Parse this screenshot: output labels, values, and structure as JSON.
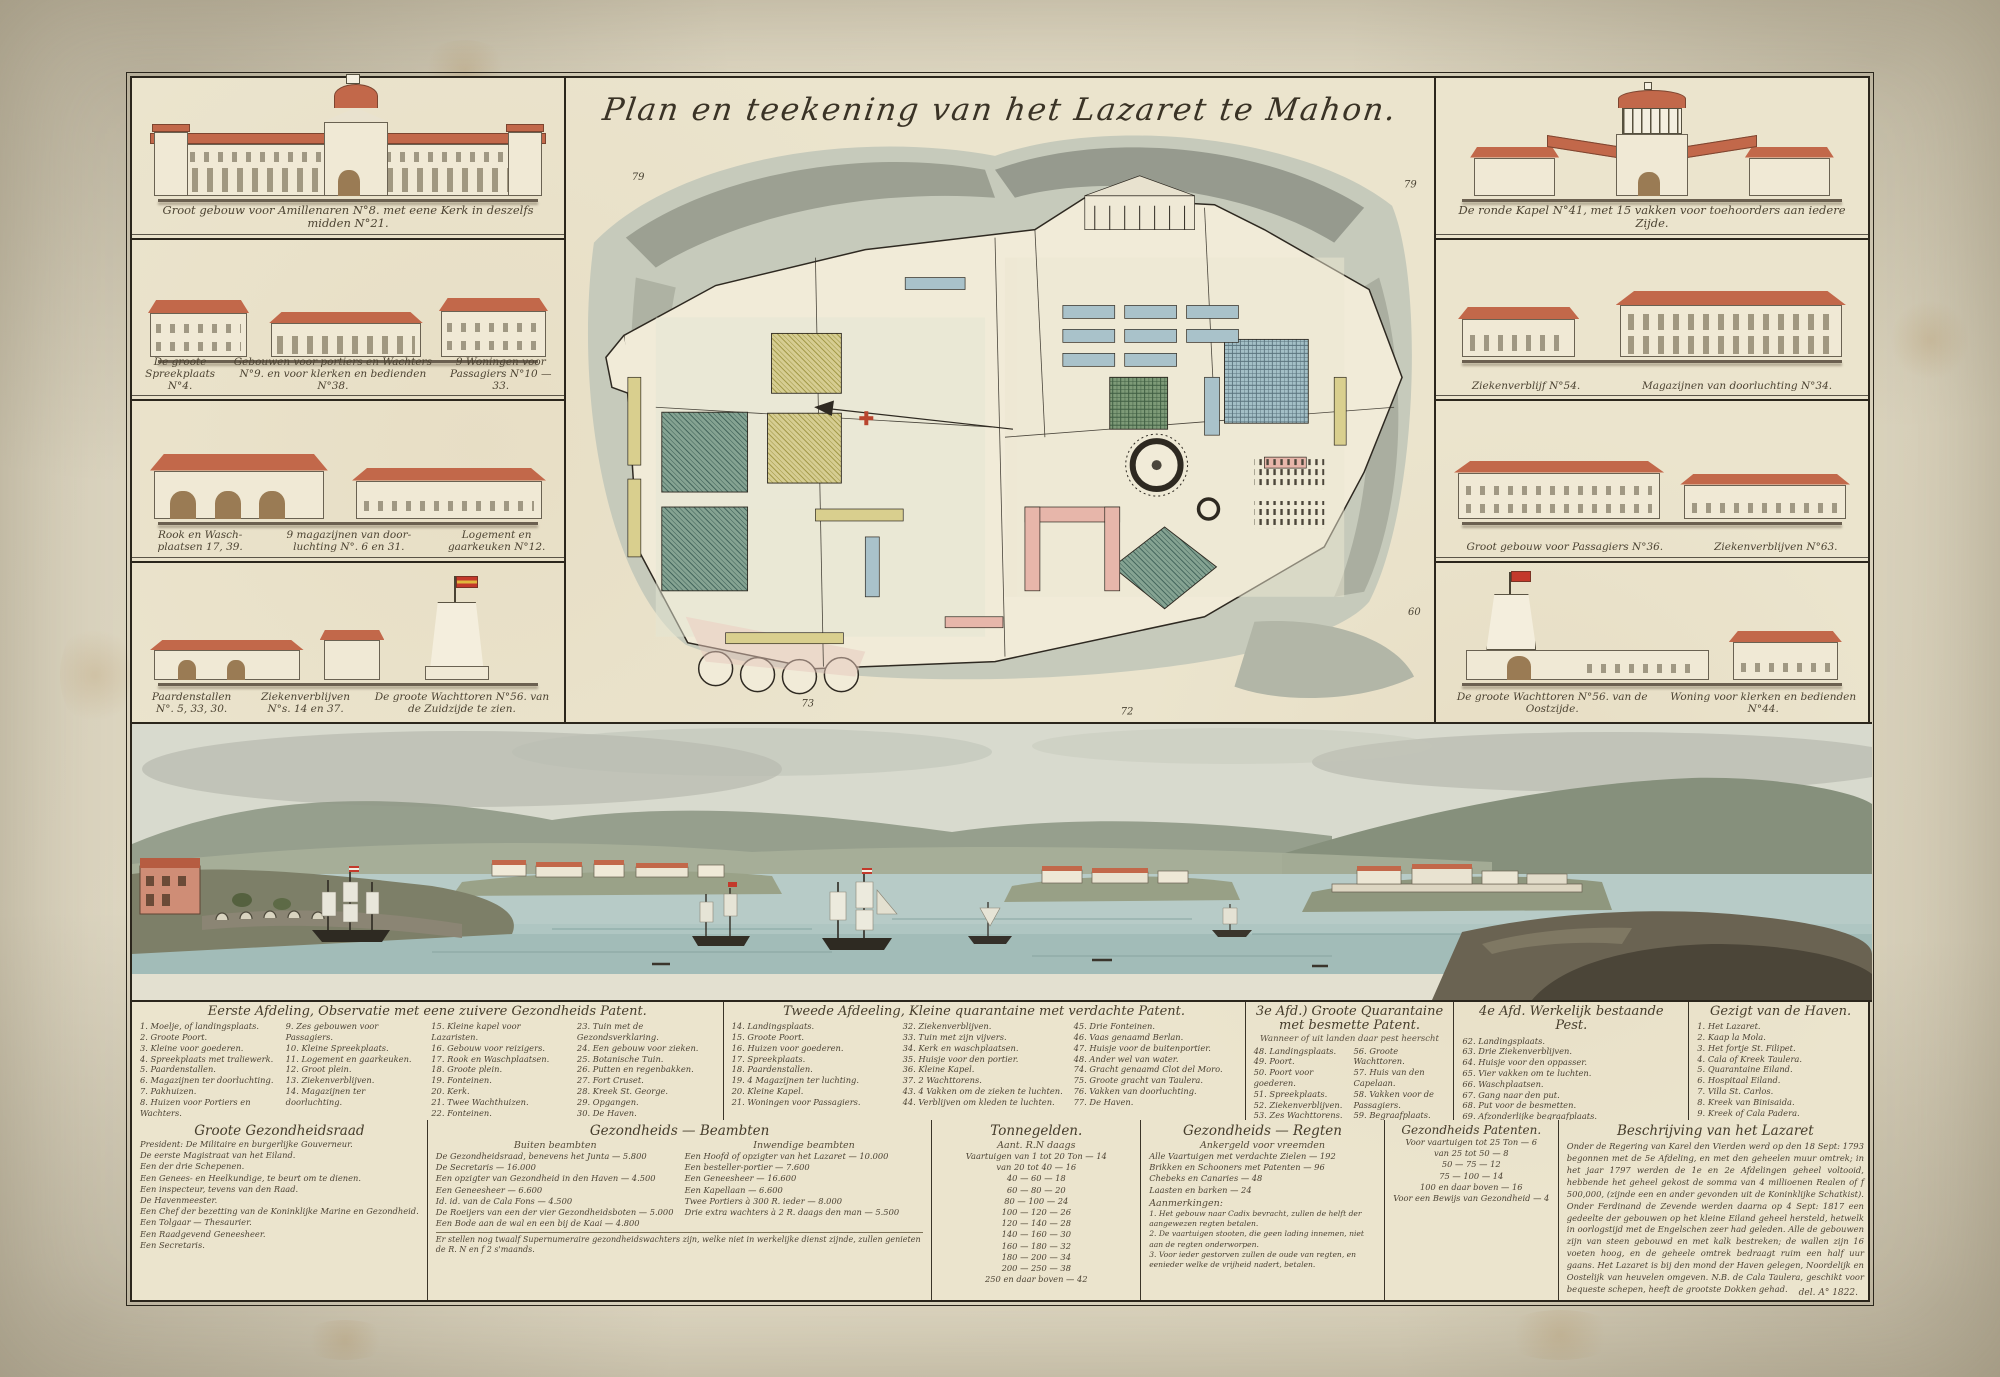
{
  "title": "Plan en teekening van het Lazaret te Mahon.",
  "left_panels": [
    {
      "caption_parts": [
        "Groot gebouw voor Amillenaren N°8. met eene Kerk in deszelfs midden N°21."
      ]
    },
    {
      "caption_parts": [
        "De groote Spreekplaats N°4.",
        "Gebouwen voor portiers en Wachters N°9. en voor klerken en bedienden N°38.",
        "9 Woningen voor Passagiers N°10 — 33."
      ]
    },
    {
      "caption_parts": [
        "Rook en Wasch- plaatsen 17, 39.",
        "9 magazijnen van door- luchting N°. 6 en 31.",
        "Logement en gaarkeuken N°12."
      ]
    },
    {
      "caption_parts": [
        "Paardenstallen N°. 5, 33, 30.",
        "Ziekenverblijven N°s. 14 en 37.",
        "De groote Wachttoren N°56. van de Zuidzijde te zien."
      ]
    }
  ],
  "right_panels": [
    {
      "caption_parts": [
        "De ronde Kapel N°41, met 15 vakken voor toehoorders aan iedere Zijde."
      ]
    },
    {
      "caption_parts": [
        "Ziekenverblijf N°54.",
        "Magazijnen van doorluchting N°34."
      ]
    },
    {
      "caption_parts": [
        "Groot gebouw voor Passagiers N°36.",
        "Ziekenverblijven N°63."
      ]
    },
    {
      "caption_parts": [
        "De groote Wachttoren N°56. van de Oostzijde.",
        "Woning voor klerken en bedienden N°44."
      ]
    }
  ],
  "plan": {
    "numbers": [
      "79",
      "79",
      "60",
      "73",
      "72"
    ]
  },
  "legend_columns": [
    {
      "header": "Eerste Afdeling, Observatie met eene zuivere Gezondheids Patent.",
      "subheader": "",
      "entries": [
        "1. Moelje, of landingsplaats.",
        "2. Groote Poort.",
        "3. Kleine voor goederen.",
        "4. Spreekplaats met traliewerk.",
        "5. Paardenstallen.",
        "6. Magazijnen ter doorluchting.",
        "7. Pakhuizen.",
        "8. Huizen voor Portiers en Wachters.",
        "9. Zes gebouwen voor Passagiers.",
        "10. Kleine Spreekplaats.",
        "11. Logement en gaarkeuken.",
        "12. Groot plein.",
        "13. Ziekenverblijven.",
        "14. Magazijnen ter doorluchting.",
        "15. Kleine kapel voor Lazaristen.",
        "16. Gebouw voor reizigers.",
        "17. Rook en Waschplaatsen.",
        "18. Groote plein.",
        "19. Fonteinen.",
        "20. Kerk.",
        "21. Twee Wachthuizen.",
        "22. Fonteinen.",
        "23. Tuin met de Gezondsverklaring.",
        "24. Een gebouw voor zieken.",
        "25. Botanische Tuin.",
        "26. Putten en regenbakken.",
        "27. Fort Cruset.",
        "28. Kreek St. George.",
        "29. Opgangen.",
        "30. De Haven."
      ]
    },
    {
      "header": "Tweede Afdeeling, Kleine quarantaine met verdachte Patent.",
      "subheader": "",
      "entries": [
        "14. Landingsplaats.",
        "15. Groote Poort.",
        "16. Huizen voor goederen.",
        "17. Spreekplaats.",
        "18. Paardenstallen.",
        "19. 4 Magazijnen ter luchting.",
        "20. Kleine Kapel.",
        "21. Woningen voor Passagiers.",
        "32. Ziekenverblijven.",
        "33. Tuin met zijn vijvers.",
        "34. Kerk en waschplaatsen.",
        "35. Huisje voor den portier.",
        "36. Kleine Kapel.",
        "37. 2 Wachttorens.",
        "43. 4 Vakken om de zieken te luchten.",
        "44. Verblijven om kleden te luchten.",
        "45. Drie Fonteinen.",
        "46. Vaas genaamd Berlan.",
        "47. Huisje voor de buitenportier.",
        "48. Ander wel van water.",
        "74. Gracht genaamd Clot del Moro.",
        "75. Groote gracht van Taulera.",
        "76. Vakken van doorluchting.",
        "77. De Haven."
      ]
    },
    {
      "header": "3e Afd.) Groote Quarantaine met besmette Patent.",
      "subheader": "Wanneer of uit landen daar pest heerscht",
      "entries": [
        "48. Landingsplaats.",
        "49. Poort.",
        "50. Poort voor goederen.",
        "51. Spreekplaats.",
        "52. Ziekenverblijven.",
        "53. Zes Wachttorens.",
        "54. Vier Kamers.",
        "55. Magazijnen ter luchting.",
        "56. Groote Wachttoren.",
        "57. Huis van den Capelaan.",
        "58. Vakken voor de Passagiers.",
        "59. Begraafplaats.",
        "60. 3 Gebouwen voor Passagiers."
      ]
    },
    {
      "header": "4e Afd. Werkelijk bestaande Pest.",
      "subheader": "",
      "entries": [
        "62. Landingsplaats.",
        "63. Drie Ziekenverblijven.",
        "64. Huisje voor den oppasser.",
        "65. Vier vakken om te luchten.",
        "66. Waschplaatsen.",
        "67. Gang naar den put.",
        "68. Put voor de besmetten.",
        "69. Afzonderlijke begraafplaats.",
        "70. Binnen ingang."
      ]
    },
    {
      "header": "Gezigt van de Haven.",
      "subheader": "",
      "entries": [
        "1. Het Lazaret.",
        "2. Kaap la Mola.",
        "3. Het fortje St. Filipet.",
        "4. Cala of Kreek Taulera.",
        "5. Quarantaine Eiland.",
        "6. Hospitaal Eiland.",
        "7. Villa St. Carlos.",
        "8. Kreek van Binisaida.",
        "9. Kreek of Cala Padera."
      ]
    }
  ],
  "bottom_sections": {
    "raad": {
      "header": "Groote Gezondheidsraad",
      "lines": [
        "President: De Militaire en burgerlijke Gouverneur.",
        "De eerste Magistraat van het Eiland.",
        "Een der drie Schepenen.",
        "Een Genees- en Heelkundige, te beurt om te dienen.",
        "Een inspecteur, tevens van den Raad.",
        "De Havenmeester.",
        "Een Chef der bezetting van de Koninklijke Marine en Gezondheid.",
        "Een Tolgaar — Thesaurier.",
        "Een Raadgevend Geneesheer.",
        "Een Secretaris."
      ]
    },
    "beambten": {
      "header": "Gezondheids — Beambten",
      "sub_left": "Buiten beambten",
      "sub_right": "Inwendige beambten",
      "amount_label": "Amb. R.N",
      "left_rows": [
        "De Gezondheidsraad, benevens het Junta — 5.800",
        "De Secretaris — 16.000",
        "Een opzigter van Gezondheid in den Haven — 4.500",
        "Een Geneesheer — 6.600",
        "Id. id. van de Cala Fons — 4.500",
        "De Roeijers van een der vier Gezondheidsboten — 5.000",
        "Een Bode aan de wal en een bij de Kaai — 4.800"
      ],
      "right_rows": [
        "Een Hoofd of opzigter van het Lazaret — 10.000",
        "Een besteller-portier — 7.600",
        "Een Geneesheer — 16.600",
        "Een Kapellaan — 6.600",
        "Twee Portiers à 300 R. ieder — 8.000",
        "Drie extra wachters à 2 R. daags den man — 5.500"
      ],
      "footer": "Er stellen nog twaalf Supernumeraire gezondheidswachters zijn, welke niet in werkelijke dienst zijnde, zullen genieten de R. N en f 2 s'maands."
    },
    "tonnegelden": {
      "header": "Tonnegelden.",
      "amount_label": "Aant. R.N daags",
      "rows": [
        "Vaartuigen van 1 tot 20 Ton — 14",
        "van 20 tot 40 — 16",
        "40 — 60 — 18",
        "60 — 80 — 20",
        "80 — 100 — 24",
        "100 — 120 — 26",
        "120 — 140 — 28",
        "140 — 160 — 30",
        "160 — 180 — 32",
        "180 — 200 — 34",
        "200 — 250 — 38",
        "250 en daar boven — 42"
      ]
    },
    "regten": {
      "header": "Gezondheids — Regten",
      "subheader": "Ankergeld voor vreemden",
      "rows": [
        "Alle Vaartuigen met verdachte Zielen — 192",
        "Brikken en Schooners met Patenten — 96",
        "Chebeks en Canaries — 48",
        "Laasten en barken — 24"
      ],
      "note_title": "Aanmerkingen:",
      "notes": [
        "1. Het gebouw naar Cadix bevracht, zullen de helft der aangewezen regten betalen.",
        "2. De vaartuigen stooten, die geen lading innemen, niet aan de regten onderworpen.",
        "3. Voor ieder gestorven zullen de oude van regten, en eenieder welke de vrijheid nadert, betalen."
      ]
    },
    "patenten": {
      "header": "Gezondheids Patenten.",
      "rows": [
        "Voor vaartuigen tot 25 Ton — 6",
        "van 25 tot 50 — 8",
        "50 — 75 — 12",
        "75 — 100 — 14",
        "100 en daar boven — 16",
        "Voor een Bewijs van Gezondheid — 4"
      ]
    },
    "beschrijving": {
      "header": "Beschrijving van het Lazaret",
      "text": "Onder de Regering van Karel den Vierden werd op den 18 Sept: 1793 begonnen met de 5e Afdeling, en met den geheelen muur omtrek; in het jaar 1797 werden de 1e en 2e Afdelingen geheel voltooid, hebbende het geheel gekost de somma van 4 millioenen Realen of f 500,000, (zijnde een en ander gevonden uit de Koninklijke Schatkist). Onder Ferdinand de Zevende werden daarna op 4 Sept: 1817 een gedeelte der gebouwen op het kleine Eiland geheel hersteld, hetwelk in oorlogstijd met de Engelschen zeer had geleden. Alle de gebouwen zijn van steen gebouwd en met kalk bestreken; de wallen zijn 16 voeten hoog, en de geheele omtrek bedraagt ruim een half uur gaans. Het Lazaret is bij den mond der Haven gelegen, Noordelijk en Oostelijk van heuvelen omgeven. N.B. de Cala Taulera, geschikt voor bequeste schepen, heeft de grootste Dokken gehad."
    }
  },
  "signature": "del. A° 1822.",
  "colors": {
    "ink": "#3d3628",
    "paper": "#ebe4cd",
    "roof_red": "#c2684a",
    "water": "#abc3c0",
    "garden_green": "#6f8a6c",
    "plan_blue": "#a9c2ca",
    "plan_pink": "#e7b6aa",
    "flag_red": "#c3392b",
    "flag_yellow": "#e0b73c"
  }
}
